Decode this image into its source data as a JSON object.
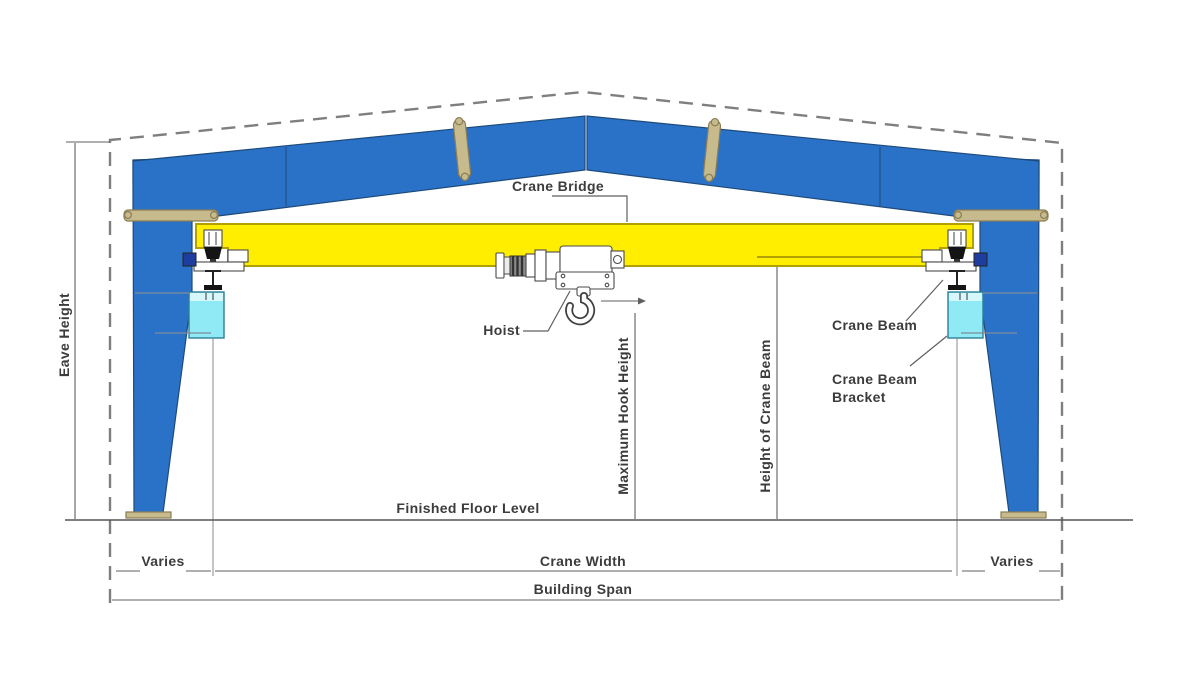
{
  "diagram": {
    "title": "Overhead crane in building cross-section",
    "labels": {
      "eave_height": "Eave Height",
      "crane_bridge": "Crane Bridge",
      "hoist": "Hoist",
      "crane_beam": "Crane Beam",
      "crane_beam_bracket_line1": "Crane Beam",
      "crane_beam_bracket_line2": "Bracket",
      "maximum_hook_height": "Maximum Hook Height",
      "height_of_crane_beam": "Height of Crane Beam",
      "finished_floor_level": "Finished Floor Level",
      "varies_left": "Varies",
      "varies_right": "Varies",
      "crane_width": "Crane Width",
      "building_span": "Building Span"
    },
    "colors": {
      "background": "#ffffff",
      "frame_blue": "#2a72c7",
      "frame_outline": "#1d4a7a",
      "girder_yellow": "#ffee00",
      "girder_outline": "#b2a000",
      "bracket_cyan": "#8feaf6",
      "bracket_cyan_light": "#d6f7fc",
      "bracket_outline": "#2e7f95",
      "plate_tan": "#c7ba8d",
      "plate_outline": "#8b7d54",
      "dashed_gray": "#7f7f7f",
      "dim_gray": "#5f5f5f",
      "text_color": "#3c3c3c",
      "hoist_white": "#ffffff",
      "hoist_outline": "#4a4a4a",
      "knob_blue": "#1d3e9e",
      "wheel_black": "#141414"
    }
  }
}
